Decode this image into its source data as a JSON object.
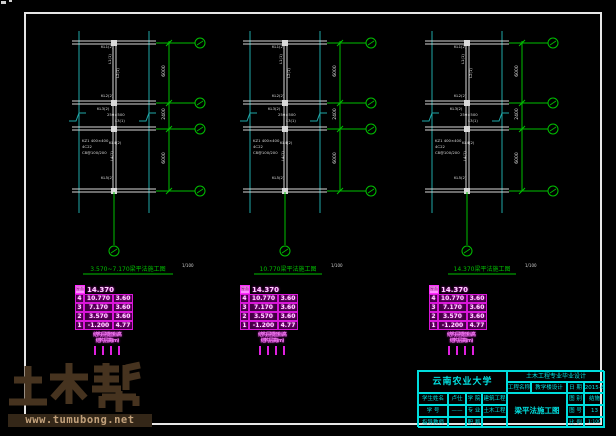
{
  "canvas": {
    "width": 616,
    "height": 436,
    "background": "#000000"
  },
  "colors": {
    "frame": "#e6e6e6",
    "cyan_line": "#1fa8a8",
    "white_line": "#d9d9d9",
    "green": "#00bf00",
    "magenta": "#e020e0",
    "titleblock_cyan": "#00e0e0",
    "watermark_brown": "#46331f",
    "watermark_bar": "#342718",
    "watermark_url_text": "#c2a17b"
  },
  "plans": [
    {
      "name": "plan-3570-7170",
      "x": 79,
      "title": "3.570~7.170梁平法施工图",
      "scale": "1/100",
      "title_cx": 128,
      "underline_w": 90
    },
    {
      "name": "plan-10770",
      "x": 250,
      "title": "10.770梁平法施工图",
      "scale": "1/100",
      "title_cx": 288,
      "underline_w": 68
    },
    {
      "name": "plan-14370",
      "x": 432,
      "title": "14.370梁平法施工图",
      "scale": "1/100",
      "title_cx": 482,
      "underline_w": 68
    }
  ],
  "dim_texts": [
    "6000",
    "2400",
    "6000"
  ],
  "beam_labels": [
    {
      "dx": 22,
      "dy": 48,
      "t": "KL1(2)",
      "rot": 0
    },
    {
      "dx": 32,
      "dy": 64,
      "t": "L1(1)",
      "rot": 1
    },
    {
      "dx": 40,
      "dy": 78,
      "t": "L2(1)",
      "rot": 1
    },
    {
      "dx": 22,
      "dy": 97,
      "t": "KL2(2)",
      "rot": 0
    },
    {
      "dx": 18,
      "dy": 110,
      "t": "KL3(2)",
      "rot": 0
    },
    {
      "dx": 28,
      "dy": 116,
      "t": "250×500",
      "rot": 0
    },
    {
      "dx": 36,
      "dy": 122,
      "t": "L3(1)",
      "rot": 0
    },
    {
      "dx": 3,
      "dy": 142,
      "t": "KZ1 400×400",
      "rot": 0
    },
    {
      "dx": 3,
      "dy": 148,
      "t": "4C22",
      "rot": 0
    },
    {
      "dx": 3,
      "dy": 154,
      "t": "C8@100/200",
      "rot": 0
    },
    {
      "dx": 30,
      "dy": 144,
      "t": "KL4(2)",
      "rot": 0
    },
    {
      "dx": 34,
      "dy": 161,
      "t": "L4(1)",
      "rot": 1
    },
    {
      "dx": 22,
      "dy": 179,
      "t": "KL5(2)",
      "rot": 0
    }
  ],
  "level_table": {
    "x_positions": [
      75,
      240,
      429
    ],
    "roof": {
      "label": "屋面",
      "elev": "14.370"
    },
    "rows": [
      [
        "4",
        "10.770",
        "3.60"
      ],
      [
        "3",
        "7.170",
        "3.60"
      ],
      [
        "2",
        "3.570",
        "3.60"
      ],
      [
        "1",
        "-1.200",
        "4.77"
      ]
    ],
    "footer": [
      "结构层楼面标高",
      "结构层高(m)"
    ]
  },
  "titleblock": {
    "university": "云南农业大学",
    "banner": "土木工程专业毕业设计",
    "project_label": "工程名称",
    "project_value": "教学楼设计",
    "date_label": "日 期",
    "date_value": "2015-6",
    "rows": [
      {
        "l1": "学生姓名",
        "v1": "卢仕",
        "l2": "学 院",
        "v2": "建筑工程"
      },
      {
        "l1": "学 号",
        "v1": "——",
        "l2": "专 业",
        "v2": "土木工程"
      },
      {
        "l1": "指导教师",
        "v1": "",
        "l2": "职 称",
        "v2": ""
      }
    ],
    "drawing_name": "梁平法施工图",
    "meta": [
      {
        "label": "图 别",
        "value": "结施"
      },
      {
        "label": "图 号",
        "value": "13"
      },
      {
        "label": "比 例",
        "value": "1:100"
      }
    ]
  },
  "watermark": {
    "brand": "土木帮",
    "url": "www.tumubong.net"
  }
}
